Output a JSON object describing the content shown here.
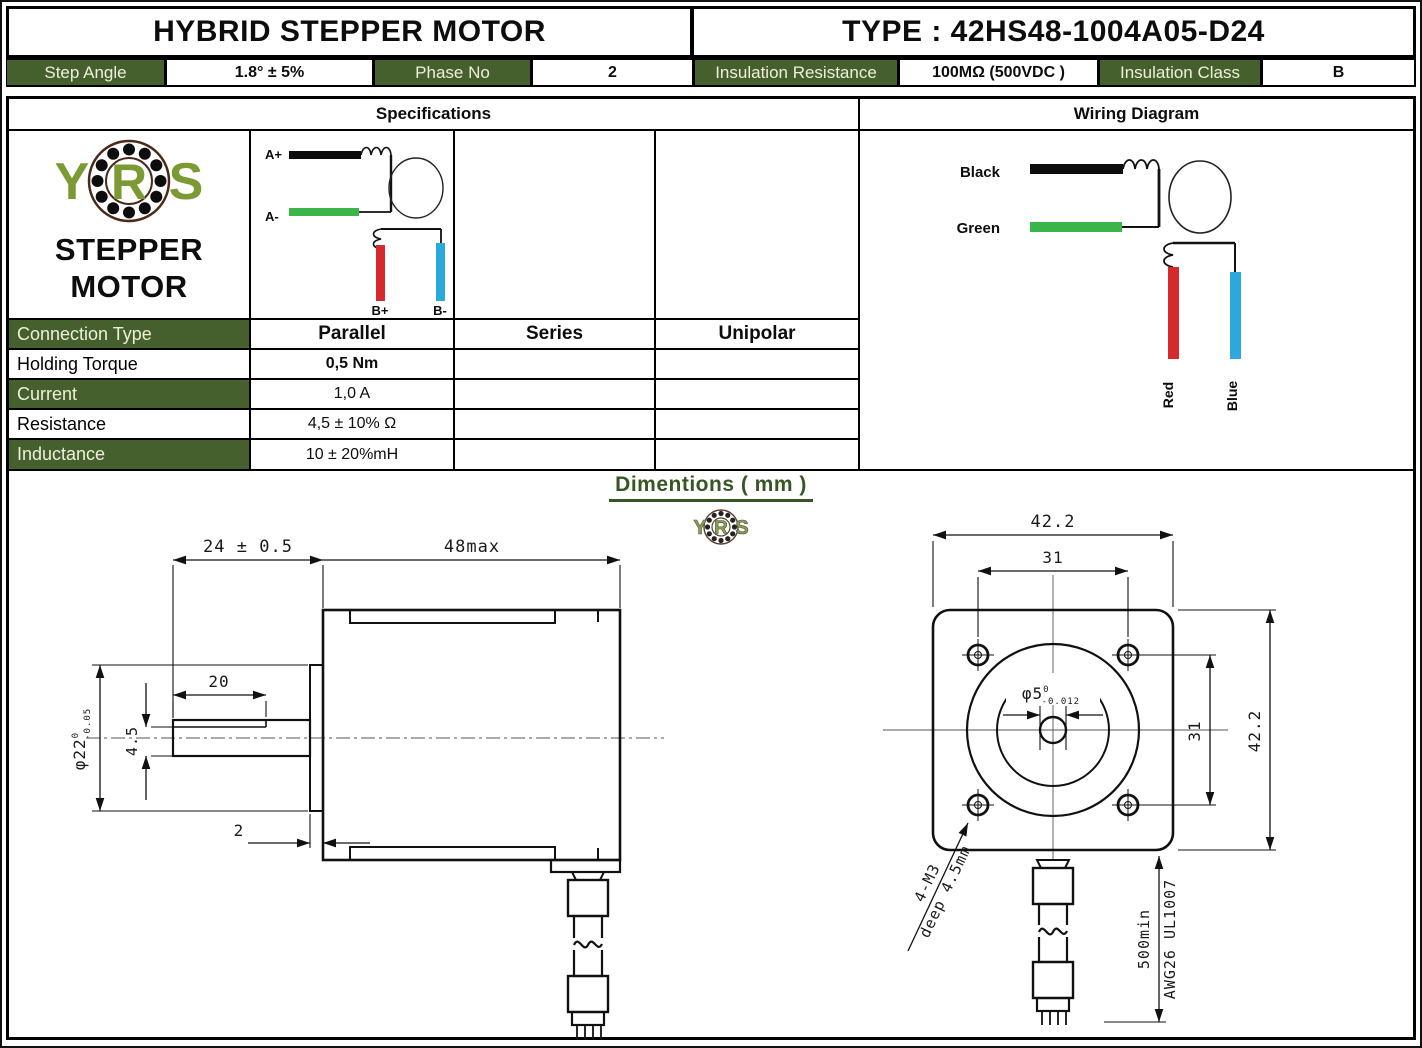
{
  "header": {
    "product_title": "HYBRID STEPPER MOTOR",
    "type_title": "TYPE : 42HS48-1004A05-D24"
  },
  "param_row": [
    {
      "label": "Step Angle",
      "value": "1.8° ± 5%"
    },
    {
      "label": "Phase No",
      "value": "2"
    },
    {
      "label": "Insulation Resistance",
      "value": "100MΩ  (500VDC )"
    },
    {
      "label": "Insulation Class",
      "value": "B"
    }
  ],
  "section_titles": {
    "specifications": "Specifications",
    "wiring_diagram": "Wiring Diagram",
    "dimensions": "Dimentions ( mm )"
  },
  "brand": {
    "letter_y": "Y",
    "letter_r": "R",
    "letter_s": "S",
    "name_line1": "STEPPER",
    "name_line2": "MOTOR"
  },
  "spec_table": {
    "row_labels": [
      "Connection Type",
      "Holding Torque",
      "Current",
      "Resistance",
      "Inductance"
    ],
    "connection_types": [
      "Parallel",
      "Series",
      "Unipolar"
    ],
    "parallel_values": {
      "holding_torque": "0,5 Nm",
      "current": "1,0 A",
      "resistance": "4,5 ± 10% Ω",
      "inductance": "10 ± 20%mH"
    }
  },
  "connection_icon_labels": {
    "a_plus": "A+",
    "a_minus": "A-",
    "b_plus": "B+",
    "b_minus": "B-"
  },
  "wiring_labels": {
    "black": "Black",
    "green": "Green",
    "red": "Red",
    "blue": "Blue"
  },
  "dimensions_side_view": {
    "shaft_length": "24 ± 0.5",
    "body_length": "48max",
    "flat_length": "20",
    "shaft_flat_height": "4.5",
    "pilot_diameter": "φ22",
    "pilot_tol_upper": "0",
    "pilot_tol_lower": "-0.05",
    "pilot_depth": "2"
  },
  "dimensions_front_view": {
    "flange_width": "42.2",
    "hole_spacing_top": "31",
    "shaft_diameter": "φ5",
    "shaft_tol_upper": "0",
    "shaft_tol_lower": "-0.012",
    "hole_spacing_side": "31",
    "flange_height": "42.2",
    "mount_note_line1": "4-M3",
    "mount_note_line2": "deep 4.5mm",
    "lead_note_line1": "500min",
    "lead_note_line2": "AWG26 UL1007"
  },
  "colors": {
    "header_green": "#45602c",
    "title_green": "#375623",
    "logo_green": "#7c9a33",
    "wire_green": "#3bb54a",
    "wire_red": "#d5292e",
    "wire_blue": "#2ba8dc"
  }
}
